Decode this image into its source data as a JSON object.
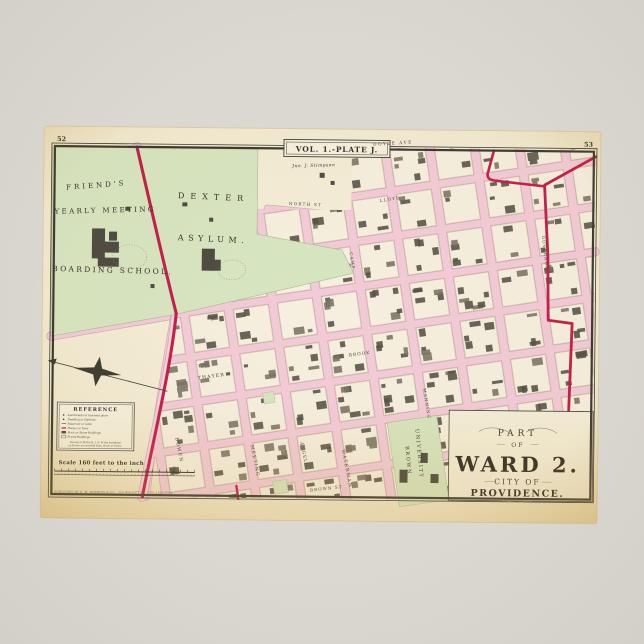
{
  "poster": {
    "description": "Vintage 1875 atlas map poster"
  },
  "colors": {
    "poster_bg": "#d8d5ce",
    "paper": "#f3ecd4",
    "paper_aged": "#e9d8ab",
    "ink": "#3b3a32",
    "park_green": "#d7e5c1",
    "street_pink": "#f3cbd8",
    "street_edge": "#cfa8b2",
    "horsecar_red": "#c21f4c",
    "building_dark": "#545147",
    "building_light": "#7a7264"
  },
  "map": {
    "page_numbers": {
      "left": "52",
      "right": "53"
    },
    "plate_label": "VOL. 1.-PLATE J.",
    "cartouche": {
      "part": "PART",
      "of": "OF",
      "ward": "WARD 2.",
      "city_of": "CITY OF",
      "providence": "PROVIDENCE."
    },
    "place_labels": [
      {
        "text": "FRIEND'S",
        "x": 97,
        "y": 187,
        "size": 7,
        "ls": 3,
        "rot": -5
      },
      {
        "text": "YEARLY MEETING",
        "x": 106,
        "y": 212,
        "size": 7,
        "ls": 2.4,
        "rot": -2
      },
      {
        "text": "BOARDING SCHOOL.",
        "x": 114,
        "y": 272,
        "size": 7.4,
        "ls": 2.4,
        "rot": 1
      },
      {
        "text": "DEXTER",
        "x": 214,
        "y": 198,
        "size": 8,
        "ls": 6,
        "rot": 2
      },
      {
        "text": "ASYLUM.",
        "x": 214,
        "y": 240,
        "size": 8,
        "ls": 4.5,
        "rot": 2
      },
      {
        "text": "Jno. J. Stimpson",
        "x": 314,
        "y": 164,
        "size": 4.4,
        "ls": 0.5,
        "rot": -2,
        "italic": true
      },
      {
        "text": "BROWN",
        "x": 410,
        "y": 457,
        "size": 5,
        "ls": 1.6,
        "rot": 84
      },
      {
        "text": "UNIVERSITY",
        "x": 421,
        "y": 450,
        "size": 5,
        "ls": 1.6,
        "rot": 84
      }
    ],
    "street_labels": [
      {
        "text": "DOYLE AVE",
        "x": 393,
        "y": 141,
        "size": 4.3,
        "ls": 1.5,
        "rot": -4
      },
      {
        "text": "NORTH ST",
        "x": 306,
        "y": 203,
        "size": 4.2,
        "ls": 1.2,
        "rot": 2
      },
      {
        "text": "LLOYD",
        "x": 391,
        "y": 197,
        "size": 4.2,
        "ls": 1.2,
        "rot": -9
      },
      {
        "text": "CAMP",
        "x": 352,
        "y": 258,
        "size": 4.2,
        "ls": 1,
        "rot": 81
      },
      {
        "text": "THAYER",
        "x": 214,
        "y": 376,
        "size": 4.6,
        "ls": 1.2,
        "rot": -8
      },
      {
        "text": "BOWEN",
        "x": 181,
        "y": 449,
        "size": 4.6,
        "ls": 1.2,
        "rot": 78
      },
      {
        "text": "MEETING",
        "x": 257,
        "y": 459,
        "size": 4.6,
        "ls": 1.2,
        "rot": 78
      },
      {
        "text": "ANGELL",
        "x": 306,
        "y": 452,
        "size": 4.3,
        "ls": 1,
        "rot": 78
      },
      {
        "text": "WATERMAN",
        "x": 349,
        "y": 466,
        "size": 4.6,
        "ls": 1.2,
        "rot": 78
      },
      {
        "text": "BROWN ST",
        "x": 330,
        "y": 487,
        "size": 4.2,
        "ls": 1,
        "rot": -7
      },
      {
        "text": "BROOK",
        "x": 362,
        "y": 352,
        "size": 4.3,
        "ls": 1,
        "rot": -8
      },
      {
        "text": "MANNING",
        "x": 428,
        "y": 400,
        "size": 4.3,
        "ls": 1,
        "rot": 80
      },
      {
        "text": "GOVERNOR",
        "x": 545,
        "y": 248,
        "size": 4.3,
        "ls": 1,
        "rot": 83
      }
    ],
    "legend": {
      "title": "REFERENCE",
      "items": [
        "Apartments or business place",
        "Dwelling or Hydrant",
        "Reservoir or Gate",
        "Horse car lines",
        "Brick or Stone Buildings",
        "Frame Buildings"
      ],
      "note_lines": [
        "Except in Plates B, I, N, W the buildings",
        "of Frame are marked thus, Brick or Stone."
      ],
      "scale_text": "Scale 160 feet to the inch"
    },
    "imprint": "PUBLISHED BY G. M. HOPKINS & CO., 320 WALNUT ST., PHILADELPHIA."
  }
}
